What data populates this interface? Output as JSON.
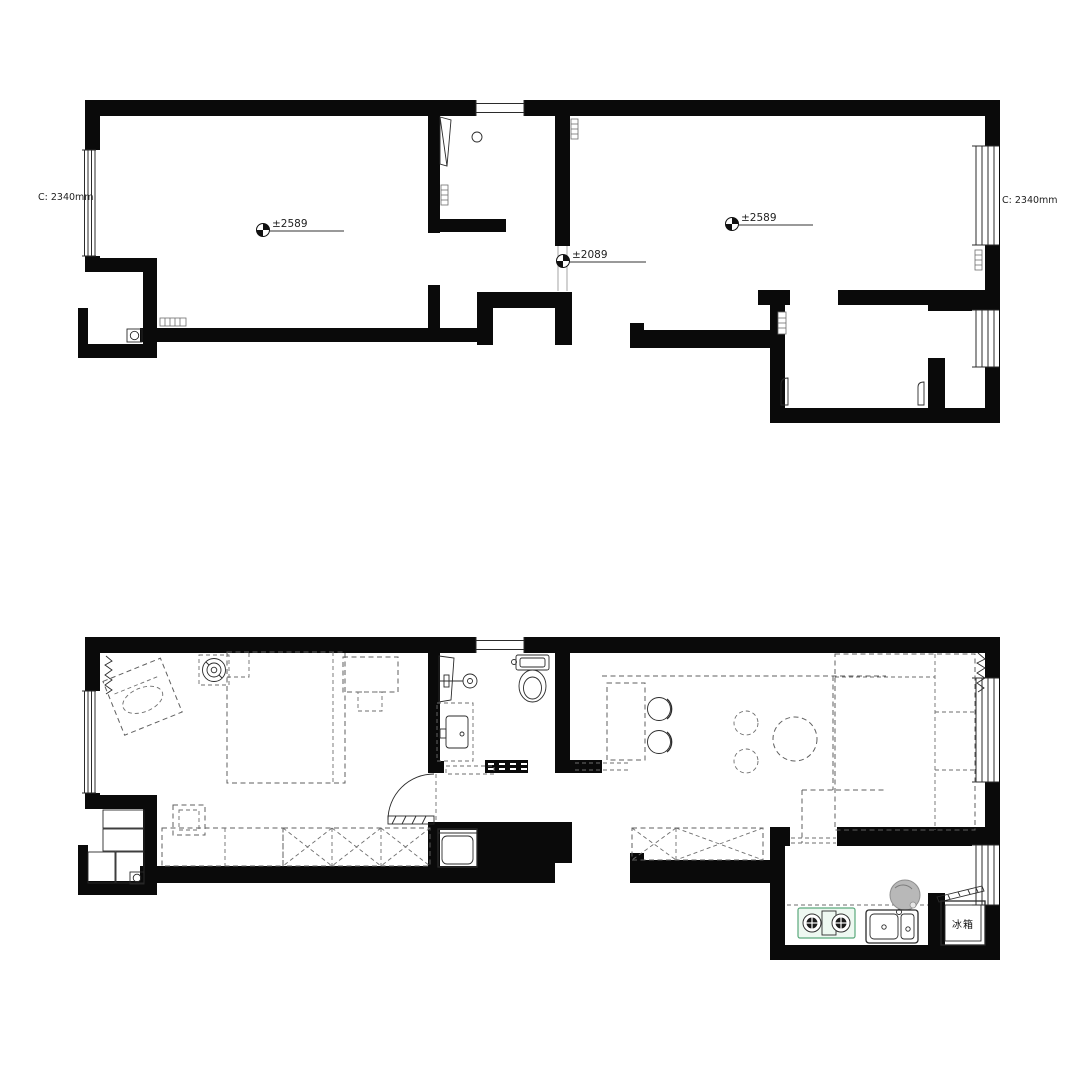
{
  "colors": {
    "wall": "#0a0a0a",
    "furniture_line": "#5f5f5f",
    "stove_accent": "#5aa97c",
    "boiler_shade": "#b8b8b8",
    "background": "#ffffff"
  },
  "upper_plan": {
    "labels": {
      "ceiling_left": "C: 2340mm",
      "ceiling_right": "C: 2340mm",
      "level_left_room": "±2589",
      "level_hall": "±2089",
      "level_right_room": "±2589"
    }
  },
  "lower_plan": {
    "labels": {
      "fridge": "冰箱"
    }
  }
}
